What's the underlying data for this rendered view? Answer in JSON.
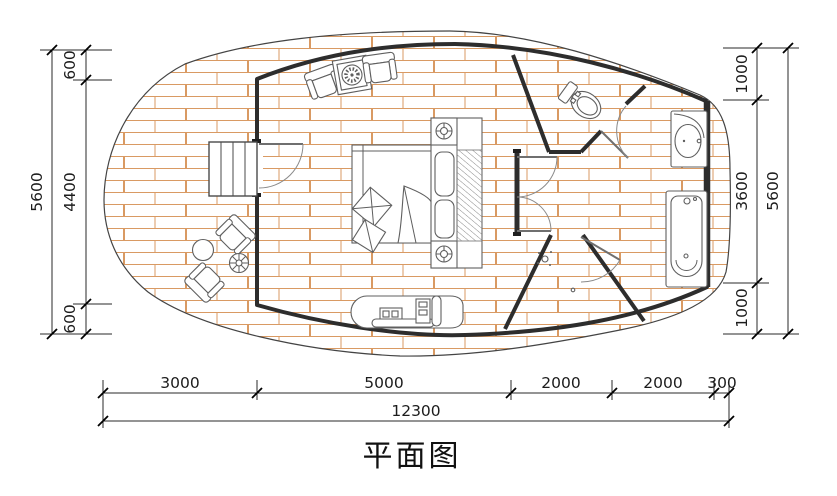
{
  "title": "平面图",
  "colors": {
    "deck_plank": "#d99a63",
    "wall": "#2d2d2d",
    "furniture_line": "#5f5f5f",
    "dimension_line": "#1c1c1c"
  },
  "dimensions": {
    "left": {
      "overall": "5600",
      "segments": [
        "600",
        "4400",
        "600"
      ]
    },
    "right": {
      "overall": "5600",
      "segments": [
        "1000",
        "3600",
        "1000"
      ]
    },
    "bottom": {
      "overall": "12300",
      "segments": [
        "3000",
        "5000",
        "2000",
        "2000",
        "300"
      ]
    }
  }
}
